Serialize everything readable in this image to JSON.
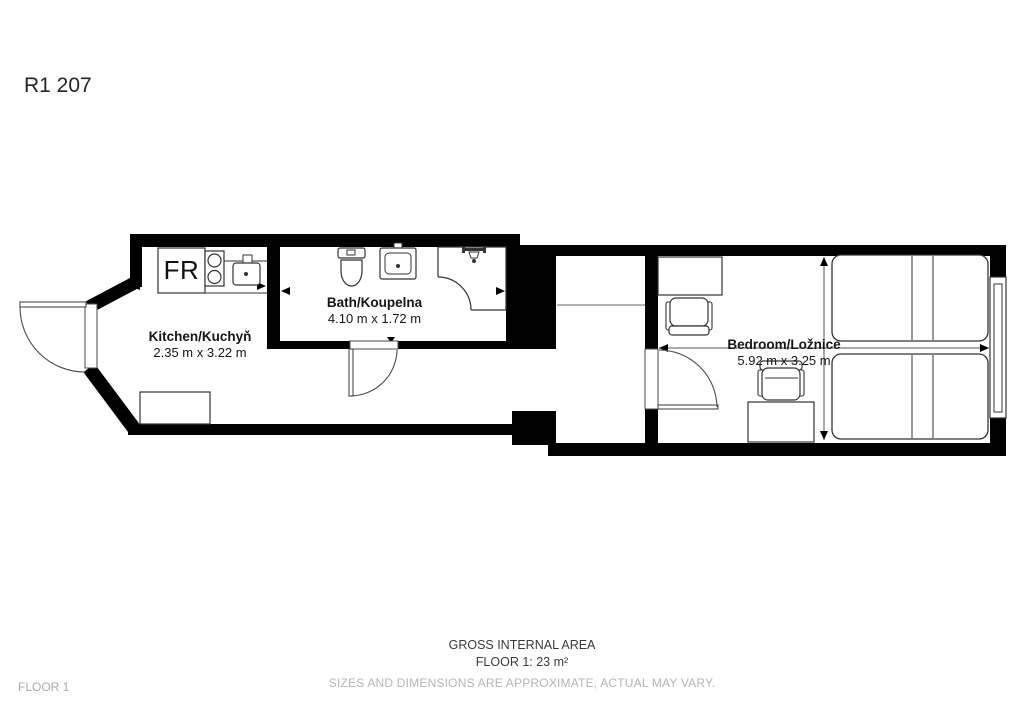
{
  "title": "R1 207",
  "floor_label": "FLOOR 1",
  "rooms": [
    {
      "name": "Kitchen/Kuchyň",
      "dimensions": "2.35 m x 3.22 m"
    },
    {
      "name": "Bath/Koupelna",
      "dimensions": "4.10 m x 1.72 m"
    },
    {
      "name": "Bedroom/Ložnice",
      "dimensions": "5.92 m x 3.25 m"
    }
  ],
  "labels": {
    "fridge": "FR"
  },
  "footer": {
    "area_title": "GROSS INTERNAL AREA",
    "area_value": "FLOOR 1: 23 m²",
    "disclaimer": "SIZES AND DIMENSIONS ARE APPROXIMATE, ACTUAL MAY VARY."
  },
  "colors": {
    "wall": "#000000",
    "fixture_line": "#333333",
    "text": "#161616",
    "muted_text": "#b5b5b5"
  }
}
